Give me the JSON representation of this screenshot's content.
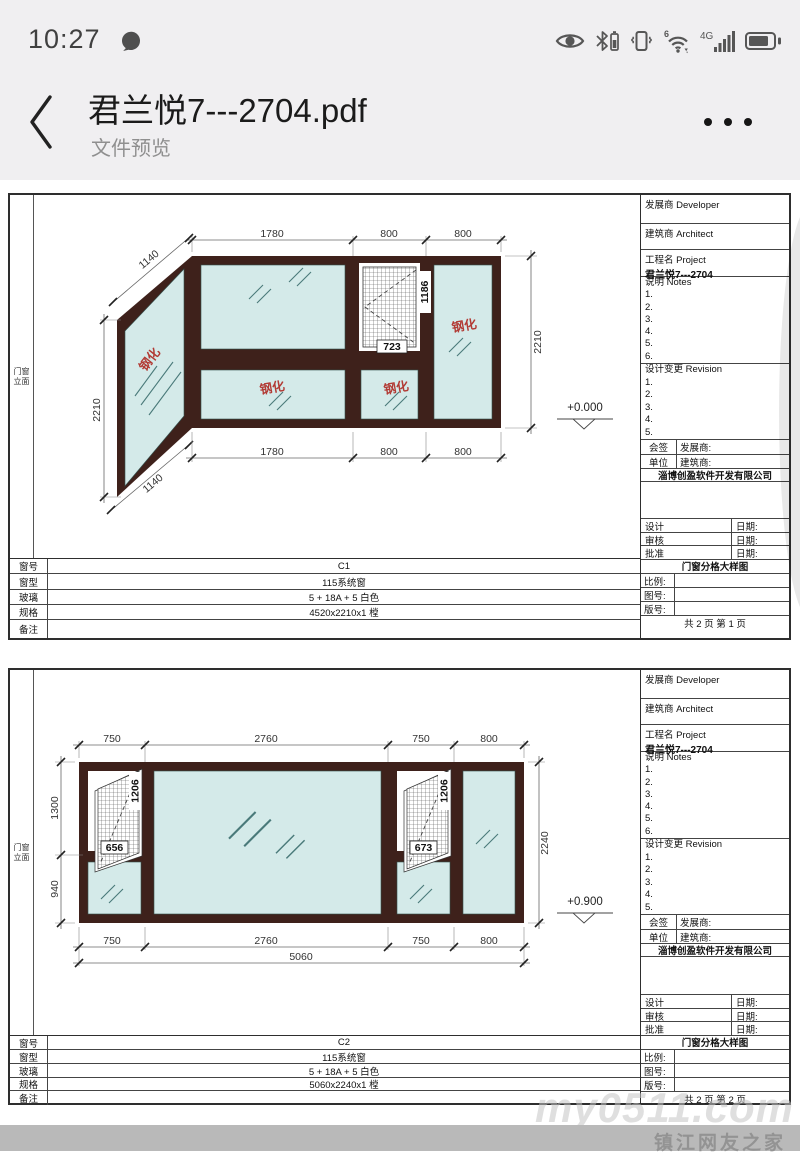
{
  "status": {
    "time": "10:27",
    "wifi_gen": "6",
    "network": "4G"
  },
  "header": {
    "title": "君兰悦7---2704.pdf",
    "subtitle": "文件预览"
  },
  "side_label": {
    "l1": "门窗",
    "l2": "立面"
  },
  "tb": {
    "developer": "发展商 Developer",
    "architect": "建筑商 Architect",
    "project": "工程名 Project",
    "project_name": "君兰悦7---2704",
    "notes": "说明 Notes",
    "notes_lines": [
      "1.",
      "2.",
      "3.",
      "4.",
      "5.",
      "6."
    ],
    "revision": "设计变更 Revision",
    "revision_lines": [
      "1.",
      "2.",
      "3.",
      "4.",
      "5."
    ],
    "countersign": "会签",
    "unit": "单位",
    "developer_colon": "发展商:",
    "architect_colon": "建筑商:",
    "company": "淄博创盈软件开发有限公司",
    "design": "设计",
    "review": "审核",
    "approve": "批准",
    "date": "日期:",
    "drawing_title": "门窗分格大样图",
    "scale": "比例:",
    "drawing_no": "图号:",
    "version_no": "版号:"
  },
  "spec_labels": {
    "win_no": "窗号",
    "win_type": "窗型",
    "glass": "玻璃",
    "size": "规格",
    "remark": "备注"
  },
  "sheet1": {
    "page_info": "共 2 页  第 1 页",
    "spec": {
      "win_no": "C1",
      "win_type": "115系统窗",
      "glass": "5 + 18A + 5 白色",
      "size": "4520x2210x1 樘",
      "remark": ""
    },
    "d": {
      "top1": "1780",
      "top2": "800",
      "top3": "800",
      "bot1": "1780",
      "bot2": "800",
      "bot3": "800",
      "left": "2210",
      "right": "2210",
      "slope_top": "1140",
      "slope_bot": "1140",
      "mesh_h": "1186",
      "mesh_w": "723",
      "level": "+0.000",
      "tempered": "钢化"
    }
  },
  "sheet2": {
    "page_info": "共 2 页  第 2 页",
    "spec": {
      "win_no": "C2",
      "win_type": "115系统窗",
      "glass": "5 + 18A + 5 白色",
      "size": "5060x2240x1 樘",
      "remark": ""
    },
    "d": {
      "top1": "750",
      "top2": "2760",
      "top3": "750",
      "top4": "800",
      "bot1": "750",
      "bot2": "2760",
      "bot3": "750",
      "bot4": "800",
      "total": "5060",
      "left1": "1300",
      "left2": "940",
      "right": "2240",
      "mesh_h_l": "1206",
      "mesh_w_l": "656",
      "mesh_h_r": "1206",
      "mesh_w_r": "673",
      "level": "+0.900"
    }
  },
  "watermark": {
    "line1": "my0511.com",
    "line2": "镇江网友之家"
  },
  "colors": {
    "frame": "#3e211b",
    "glass": "#d4eae9",
    "tempered": "#b23b35",
    "band": "#b9b9b9"
  }
}
